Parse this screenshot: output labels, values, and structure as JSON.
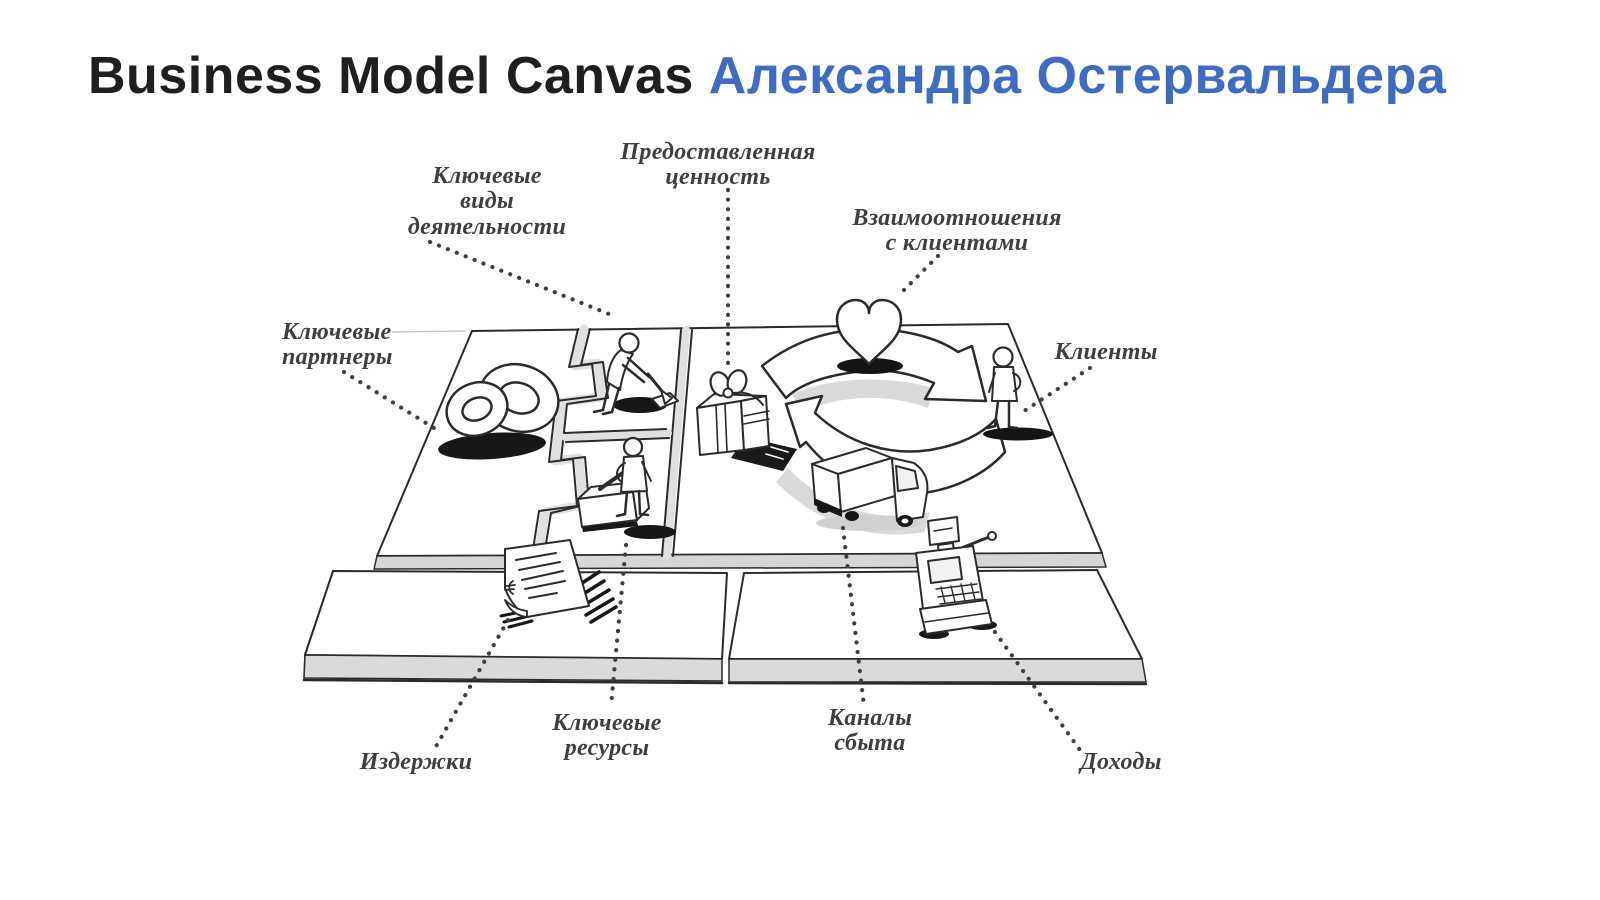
{
  "title": {
    "product": "Business Model Canvas",
    "author": "Александра Остервальдера"
  },
  "colors": {
    "title_ink": "#1f1f1f",
    "title_accent": "#3e6cc4",
    "label_ink": "#3f3f3f",
    "sketch_ink": "#2b2b2b",
    "shadow_dark": "#171717",
    "surface_gray": "#d9d9d9"
  },
  "diagram": {
    "labels": {
      "key_partners": "Ключевые\nпартнеры",
      "key_activities": "Ключевые\nвиды\nдеятельности",
      "value_proposition": "Предоставленная\nценность",
      "customer_relationships": "Взаимоотношения\nс клиентами",
      "customers": "Клиенты",
      "key_resources": "Ключевые\nресурсы",
      "costs": "Издержки",
      "sales_channels": "Каналы\nсбыта",
      "revenue": "Доходы"
    },
    "icons": [
      "interlocked-rings",
      "digging-person",
      "gift-box",
      "heart",
      "truck",
      "standing-person",
      "worker-with-machine",
      "invoice",
      "cash-register"
    ]
  }
}
